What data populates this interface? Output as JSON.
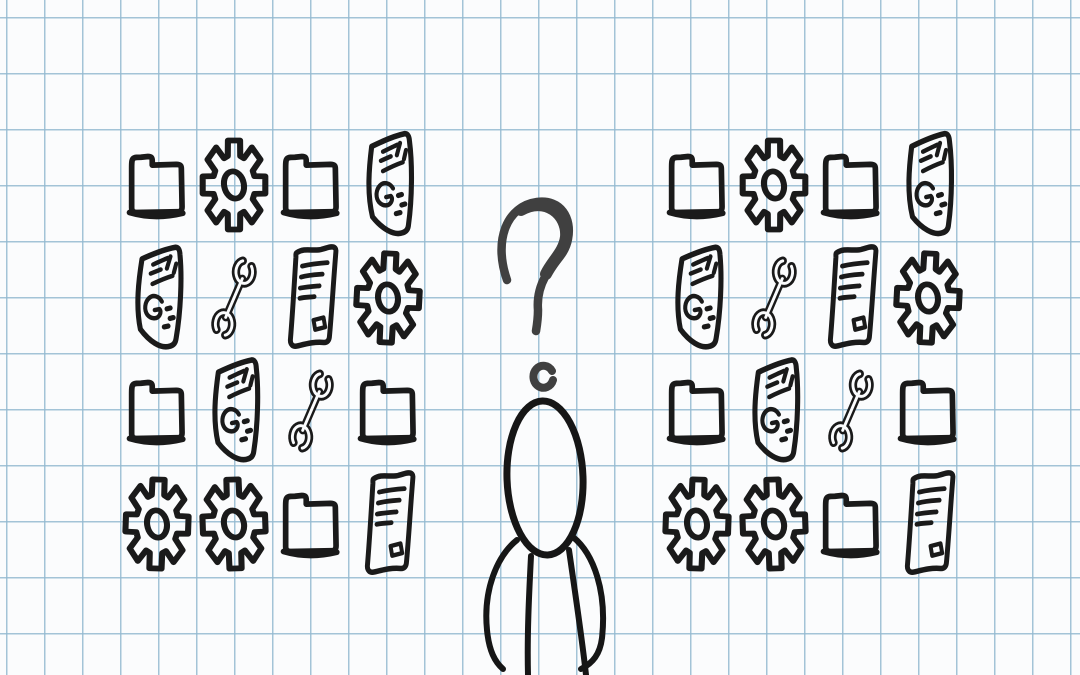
{
  "scene": {
    "description": "Hand-drawn sketch on blue graph paper: a confused stick figure with a question mark over its head stands between two identical 4x4 grids of folder, gear, document and wrench doodle icons.",
    "background": "graph-paper",
    "panels_identical": true,
    "grid_size": "4x4"
  },
  "colors": {
    "paper": "#fbfcfd",
    "grid_line": "#94b9d0",
    "ink": "#1a1a1a",
    "question_mark_ink": "#404040"
  },
  "icon_panels": {
    "left": {
      "rows": [
        [
          "folder",
          "gear",
          "folder",
          "document-g"
        ],
        [
          "document-g",
          "wrench",
          "document-lines",
          "gear"
        ],
        [
          "folder",
          "document-g",
          "wrench",
          "folder"
        ],
        [
          "gear",
          "gear",
          "folder",
          "document-lines"
        ]
      ]
    },
    "right": {
      "rows": [
        [
          "folder",
          "gear",
          "folder",
          "document-g"
        ],
        [
          "document-g",
          "wrench",
          "document-lines",
          "gear"
        ],
        [
          "folder",
          "document-g",
          "wrench",
          "folder"
        ],
        [
          "gear",
          "gear",
          "folder",
          "document-lines"
        ]
      ]
    }
  },
  "figure": {
    "elements": [
      "question-mark",
      "question-mark-dot",
      "head",
      "left-arm",
      "right-arm",
      "left-body-line",
      "right-body-line"
    ]
  }
}
